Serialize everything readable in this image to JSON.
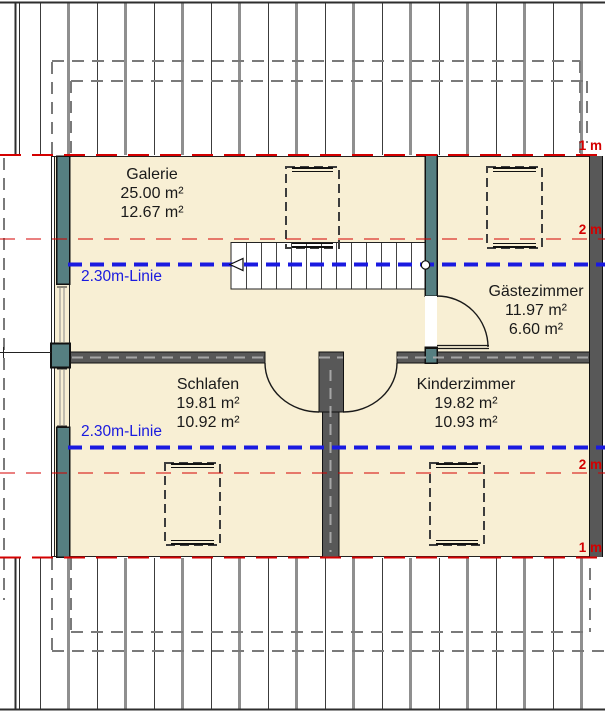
{
  "plan": {
    "title": "Dachgeschoss Grundriss",
    "rooms": [
      {
        "id": "galerie",
        "name": "Galerie",
        "area_total": "25.00 m²",
        "area_living": "12.67 m²"
      },
      {
        "id": "gaestezimmer",
        "name": "Gästezimmer",
        "area_total": "11.97 m²",
        "area_living": "6.60 m²"
      },
      {
        "id": "schlafen",
        "name": "Schlafen",
        "area_total": "19.81 m²",
        "area_living": "10.92 m²"
      },
      {
        "id": "kinderzimmer",
        "name": "Kinderzimmer",
        "area_total": "19.82 m²",
        "area_living": "10.93 m²"
      }
    ],
    "height_lines": {
      "blue_line_label": "2.30m-Linie",
      "red_marks": [
        {
          "id": "top-1m",
          "label": "1 m"
        },
        {
          "id": "top-2m",
          "label": "2 m"
        },
        {
          "id": "bottom-2m",
          "label": "2 m"
        },
        {
          "id": "bottom-1m",
          "label": "1 m"
        }
      ]
    },
    "colors": {
      "room_fill": "#f8efd4",
      "wall_teal": "#567f81",
      "wall_gray": "#585858",
      "line_red": "#d40000",
      "line_blue": "#1a1ae0"
    }
  }
}
